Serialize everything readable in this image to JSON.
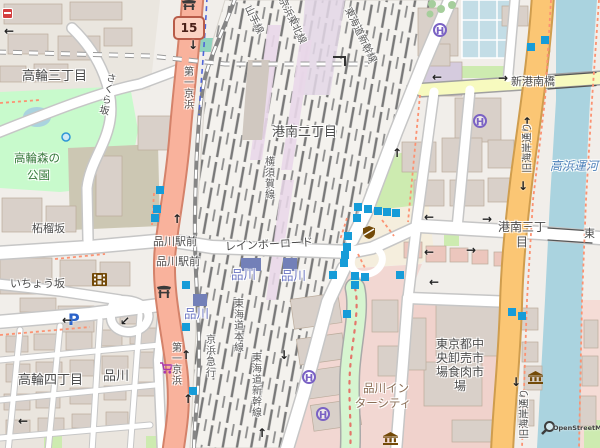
{
  "map": {
    "attribution": "OpenStreetMap",
    "route_shield": "15",
    "colors": {
      "trunk_road": "#f9b29c",
      "primary_road": "#fbc674",
      "secondary_road": "#f7fabf",
      "water": "#aad3df",
      "park": "#c8facc",
      "grass": "#cdebb0",
      "retail_area": "#f2d7d2",
      "building": "#d9d0c9",
      "rail_track": "#787878",
      "bus_stop": "#169cd8",
      "station_label": "#6d77c3",
      "poi_brown": "#734a08",
      "shop_purple": "#ac39ac",
      "helipad_purple": "#7a62c4",
      "footpath_red": "#fa8072"
    },
    "icons": {
      "oneway_up": "↑",
      "oneway_down": "↓",
      "oneway_left": "←",
      "oneway_right": "→",
      "oneway_downleft": "↙",
      "parking": "P",
      "helipad": "H"
    },
    "labels": {
      "districts": {
        "takanawa_3chome": "高輪三丁目",
        "takanawa_4chome": "高輪四丁目",
        "konan_2chome": "港南二丁目",
        "konan_3chome_line1": "港南三丁",
        "konan_3chome_line2": "目",
        "shinagawa": "品川"
      },
      "streets": {
        "daiichi_keihin": "第一京浜",
        "zakurozaka": "柘榴坂",
        "sakurazaka": "さくら坂",
        "ichozaka": "いちょう坂",
        "rainbow_road": "レインボーロード",
        "shinkonanbashi": "新港南橋",
        "kyu_kaigan_dori": "旧海岸通り",
        "higashi": "東",
        "shinagawa_ekimae": "品川駅前"
      },
      "stations": {
        "shinagawa": "品川"
      },
      "railways": {
        "yamanote": "山手線",
        "keihin_tohoku": "京浜東北線",
        "tokaido_shinkansen": "東海道新幹線",
        "yokosuka": "横須賀線",
        "tokaido_main": "東海道本線",
        "keikyu": "京浜急行"
      },
      "areas": {
        "park_line1": "高輪森の",
        "park_line2": "公園",
        "intercity_line1": "品川イン",
        "intercity_line2": "ターシティ",
        "market_line1": "東京都中",
        "market_line2": "央卸売市",
        "market_line3": "場食肉市",
        "market_line4": "場"
      },
      "water": {
        "takahama_canal": "高浜運河"
      }
    }
  }
}
